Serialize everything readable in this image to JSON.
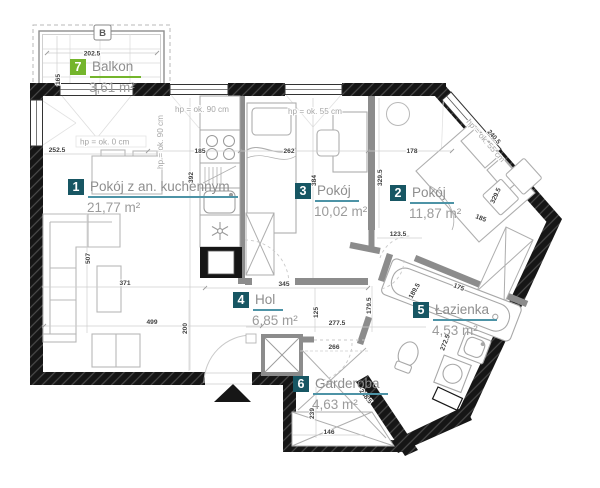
{
  "plan_title": "apartment floor plan",
  "marker_b": "B",
  "rooms": [
    {
      "num": "1",
      "name": "Pokój z an. kuchennym",
      "area": "21,77 m²"
    },
    {
      "num": "2",
      "name": "Pokój",
      "area": "11,87 m²"
    },
    {
      "num": "3",
      "name": "Pokój",
      "area": "10,02 m²"
    },
    {
      "num": "4",
      "name": "Hol",
      "area": "6,85 m²"
    },
    {
      "num": "5",
      "name": "Łazienka",
      "area": "4,53 m²"
    },
    {
      "num": "6",
      "name": "Garderoba",
      "area": "4,63 m²"
    },
    {
      "num": "7",
      "name": "Balkon",
      "area": "3,61 m²"
    }
  ],
  "hp": [
    "hp = ok. 0 cm",
    "hp = ok. 90 cm",
    "hp = ok. 90 cm",
    "hp = ok. 55 cm",
    "hp = ok. 55 cm"
  ],
  "dims": {
    "balcony_width": "202.5",
    "balcony_depth": "165",
    "balcony_door": "252.5",
    "kitchen_width": "185",
    "room3_width": "262",
    "room2_width": "178",
    "room1_depth": "392",
    "room3_depth": "384",
    "room2_depth": "329.5",
    "room2_wall": "329.5",
    "room2_window": "240.5",
    "room2_side": "185",
    "pass_width": "123.5",
    "hol_width": "345",
    "hol_125": "125",
    "hol_277": "277.5",
    "hol_266": "266",
    "hol_179": "179.5",
    "bath_wall": "189.5",
    "tub_length": "175",
    "bath_depth": "272.5",
    "sofa_length": "507",
    "living_371": "371",
    "living_499": "499",
    "living_200": "200",
    "gard_depth": "239",
    "gard_wall": "248.5",
    "gard_width": "146"
  },
  "colors": {
    "badge_teal": "#175663",
    "badge_green": "#74B52C",
    "underline_teal": "#4D93A6",
    "wall_black": "#161616"
  }
}
